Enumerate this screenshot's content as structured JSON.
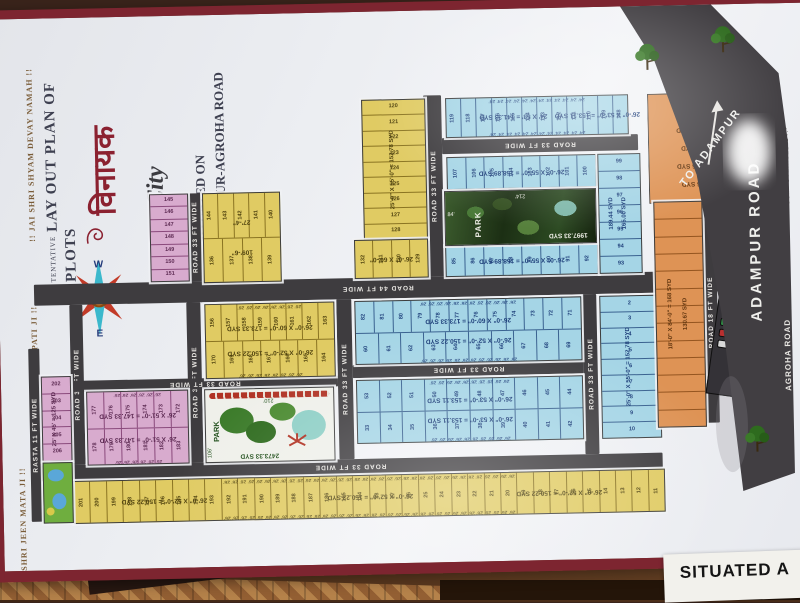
{
  "title": {
    "tentative": "TENTATIVE",
    "main": "LAY OUT PLAN OF PLOTS",
    "logo_devanagari": "विनायक",
    "logo_script": "City",
    "situated_on": "SITUATED ON",
    "situated_road": "ADAMPUR-AGROHA ROAD"
  },
  "chants": {
    "left_top": "!! JAI SHRI SHYAM DEVAY NAMAH !!",
    "left_mid": "!! JAI SHRI GANPATI JI !!",
    "left_bottom": "!! JAI SHRI JEEN MATA JI !!"
  },
  "compass": {
    "n": "N",
    "e": "E",
    "s": "S",
    "w": "W"
  },
  "highway": {
    "to": "TO ADAMPUR",
    "name": "ADAMPUR ROAD",
    "agroha": "AGROHA ROAD"
  },
  "misc": {
    "computerised": "COMPUTERISED BY:-",
    "corner_sheet": "SITUATED A"
  },
  "parks": {
    "park_photo": {
      "label": "PARK",
      "area": "1997.33 SYD",
      "left_dim": "84'",
      "top_dim": "214'"
    },
    "park_drawn": {
      "label": "PARK",
      "area": "2473.33 SYD",
      "top_dim": "210'",
      "left_dim": "106'"
    }
  },
  "parking": {
    "title": "PARKING",
    "rows": [
      [
        "#b92f2f",
        "#d8d8d8"
      ],
      [
        "#d8a92f",
        "#2f52b9"
      ],
      [
        "#2f9b47",
        "#e8e8e8"
      ],
      [
        "#b92f2f",
        "#7a2fb9"
      ],
      [
        "#d8d8d8",
        "#c9662a"
      ]
    ]
  },
  "plan": {
    "roads": [
      {
        "label": "ROAD 33 FT WIDE",
        "o": "v",
        "x": 428,
        "y": 85,
        "w": 18,
        "h": 181
      },
      {
        "label": "ROAD 33 FT WIDE",
        "o": "h",
        "x": 446,
        "y": 128,
        "w": 196,
        "h": 16
      },
      {
        "label": "ROAD 33 FT WIDE",
        "o": "v",
        "x": 190,
        "y": 178,
        "w": 14,
        "h": 88
      },
      {
        "label": "ROAD 44 FT WIDE",
        "o": "h",
        "x": 35,
        "y": 266,
        "w": 688,
        "h": 21
      },
      {
        "label": "ROAD 33 FT WIDE",
        "o": "v",
        "x": 70,
        "y": 287,
        "w": 13,
        "h": 160
      },
      {
        "label": "ROAD 33 FT WIDE",
        "o": "v",
        "x": 187,
        "y": 287,
        "w": 14,
        "h": 160
      },
      {
        "label": "ROAD 33 FT WIDE",
        "o": "v",
        "x": 337,
        "y": 287,
        "w": 15,
        "h": 160
      },
      {
        "label": "ROAD 33 FT WIDE",
        "o": "v",
        "x": 583,
        "y": 287,
        "w": 14,
        "h": 160
      },
      {
        "label": "ROAD 33 FT WIDE",
        "o": "h",
        "x": 352,
        "y": 353,
        "w": 231,
        "h": 13
      },
      {
        "label": "ROAD 33 FT WIDE",
        "o": "h",
        "x": 70,
        "y": 363,
        "w": 267,
        "h": 11
      },
      {
        "label": "ROAD 33 FT WIDE",
        "o": "h",
        "x": 35,
        "y": 447,
        "w": 625,
        "h": 15
      },
      {
        "label": "RASTA 11 FT WIDE",
        "o": "v",
        "x": 28,
        "y": 330,
        "w": 11,
        "h": 173
      },
      {
        "label": "ROAD 18 FT WIDE",
        "o": "v",
        "x": 704,
        "y": 198,
        "w": 14,
        "h": 220
      }
    ],
    "blocks": [
      {
        "name": "blue-row-top",
        "color": "blue",
        "x": 450,
        "y": 88,
        "w": 181,
        "h": 38,
        "rows": [
          [
            119,
            118,
            117,
            116,
            115,
            114,
            113,
            112,
            111,
            110,
            109,
            108
          ]
        ],
        "tick": "24'",
        "labels": [
          "24' X 53' = 141.33 SYD",
          "26'-0\" X 53'-0\" = 153.11 SYD"
        ],
        "lpos": [
          "4%",
          "50%"
        ]
      },
      {
        "name": "blue-row-2",
        "color": "blue",
        "x": 450,
        "y": 147,
        "w": 148,
        "h": 31,
        "rows": [
          [
            107,
            106,
            105,
            104,
            103,
            102,
            101,
            100
          ]
        ],
        "labels": [
          "26'-0\" X 55'-0\" = 158.89 SYD"
        ]
      },
      {
        "name": "blue-row-3",
        "color": "blue",
        "x": 447,
        "y": 236,
        "w": 151,
        "h": 29,
        "rows": [
          [
            85,
            86,
            87,
            88,
            89,
            90,
            91,
            92
          ]
        ],
        "labels": [
          "26'-0\" X 55'-0\" = 158.89 SYD"
        ]
      },
      {
        "name": "blue-col-right",
        "color": "blue",
        "x": 601,
        "y": 147,
        "w": 41,
        "h": 118,
        "vertical": true,
        "cells": [
          99,
          98,
          97,
          96,
          95,
          94,
          93
        ],
        "labels": [
          "189.44 SYD",
          "165.00 SYD"
        ]
      },
      {
        "name": "yellow-col",
        "color": "yellow",
        "x": 366,
        "y": 88,
        "w": 62,
        "h": 138,
        "vertical": true,
        "cells": [
          120,
          121,
          122,
          123,
          124,
          125,
          126,
          127,
          128
        ],
        "labels": [
          "25'-0\" X 55'-0\" = 152.78 SYD"
        ]
      },
      {
        "name": "yellow-row",
        "color": "yellow",
        "x": 356,
        "y": 228,
        "w": 72,
        "h": 37,
        "rows": [
          [
            132,
            131,
            130,
            129
          ]
        ],
        "labels": [
          "26'-0\" X 60'-0\""
        ]
      },
      {
        "name": "yellow-block-136",
        "color": "yellow",
        "x": 205,
        "y": 178,
        "w": 76,
        "h": 88,
        "rows": [
          [
            144,
            143,
            142,
            141,
            140
          ],
          [
            136,
            137,
            138,
            139
          ]
        ],
        "labels": [
          "27'-4\"",
          "109'-6\""
        ]
      },
      {
        "name": "pink-col",
        "color": "pink",
        "x": 152,
        "y": 178,
        "w": 37,
        "h": 86,
        "vertical": true,
        "cells": [
          145,
          146,
          147,
          148,
          149,
          150,
          151
        ]
      },
      {
        "name": "yellow-mid",
        "color": "yellow",
        "x": 205,
        "y": 289,
        "w": 128,
        "h": 73,
        "rows": [
          [
            156,
            157,
            158,
            159,
            160,
            161,
            162,
            163
          ],
          [
            170,
            169,
            168,
            167,
            166,
            165,
            164
          ]
        ],
        "tick": "26'",
        "labels": [
          "26'-0\" X 60'-0\" = 173.33 SYD",
          "26'-0\" X 52'-0\" = 150.22 SYD"
        ]
      },
      {
        "name": "blue-center-top",
        "color": "blue",
        "x": 355,
        "y": 289,
        "w": 225,
        "h": 62,
        "rows": [
          [
            82,
            81,
            80,
            79,
            78,
            77,
            76,
            75,
            74,
            73,
            72,
            71
          ],
          [
            60,
            61,
            62,
            63,
            64,
            65,
            66,
            67,
            68,
            69
          ]
        ],
        "tick": "26'",
        "labels": [
          "26'-0\" X 60'-0\" = 173.33 SYD",
          "26'-0\" X 52'-0\" = 150.22 SYD"
        ]
      },
      {
        "name": "blue-center-bottom",
        "color": "blue",
        "x": 355,
        "y": 368,
        "w": 225,
        "h": 62,
        "rows": [
          [
            53,
            52,
            51,
            50,
            49,
            48,
            47,
            46,
            45,
            44
          ],
          [
            33,
            34,
            35,
            36,
            37,
            38,
            39,
            40,
            41,
            42
          ]
        ],
        "tick": "26'",
        "labels": [
          "26'-0\" X 53'-0\" = 153.11 SYD",
          "26'-0\" X 53'-0\" = 153.11 SYD"
        ]
      },
      {
        "name": "blue-col-2-10",
        "color": "blue",
        "x": 600,
        "y": 289,
        "w": 58,
        "h": 141,
        "vertical": true,
        "cells": [
          2,
          3,
          4,
          5,
          6,
          7,
          8,
          9,
          10
        ],
        "labels": [
          "25'-0\" X 55'-0\" = 152.78 SYD"
        ]
      },
      {
        "name": "pink-block",
        "color": "pink",
        "x": 85,
        "y": 374,
        "w": 100,
        "h": 72,
        "rows": [
          [
            177,
            176,
            175,
            174,
            173,
            172
          ],
          [
            178,
            179,
            180,
            181,
            182,
            183
          ]
        ],
        "tick": "26'",
        "labels": [
          "26' X 51'-0\" = 147.33 SYD",
          "26' X 51'-0\" = 147.33 SYD"
        ]
      },
      {
        "name": "pink-small",
        "color": "pink",
        "x": 40,
        "y": 358,
        "w": 28,
        "h": 83,
        "vertical": true,
        "cells": [
          202,
          203,
          204,
          205,
          206
        ],
        "labels": [
          "25' X 45' = 125 SYD"
        ]
      },
      {
        "name": "yellow-strip",
        "color": "yellow",
        "x": 70,
        "y": 463,
        "w": 590,
        "h": 41,
        "rows": [
          [
            201,
            200,
            199,
            198,
            197,
            196,
            195,
            194,
            193,
            192,
            191,
            190,
            189,
            188,
            187,
            186,
            185,
            184,
            28,
            27,
            26,
            25,
            24,
            23,
            22,
            21,
            20,
            19,
            18,
            17,
            16,
            15,
            14,
            13,
            12,
            11
          ]
        ],
        "tick": "26'",
        "labels": [
          "26'-0\" X 52'-0\" = 150.22 SYD",
          "26'-0\" X 52'-0\" = 150.22 SYD",
          "26'-0\" X 52'-0\" = 150.22 SYD"
        ],
        "lpos": [
          "5%",
          "40%",
          "72%"
        ]
      },
      {
        "name": "orange-top",
        "color": "orange",
        "x": 652,
        "y": 88,
        "w": 90,
        "h": 108,
        "plain": true,
        "clip": "polygon(0 0,32% 0,100% 72%,100% 100%,0 100%)",
        "labels": [
          "150.88 SYD",
          "132.41 SYD",
          "145 SYD",
          "157.66 SYD",
          "166 SYD"
        ]
      },
      {
        "name": "orange-strip",
        "color": "orange",
        "x": 656,
        "y": 196,
        "w": 47,
        "h": 224,
        "vertical": true,
        "cells": [
          "",
          "",
          "",
          "",
          "",
          "",
          "",
          "",
          "",
          "",
          "",
          "",
          ""
        ],
        "labels": [
          "18'-0\" X 84'-0\" = 168 SYD",
          "130.67 SYD"
        ]
      }
    ]
  }
}
